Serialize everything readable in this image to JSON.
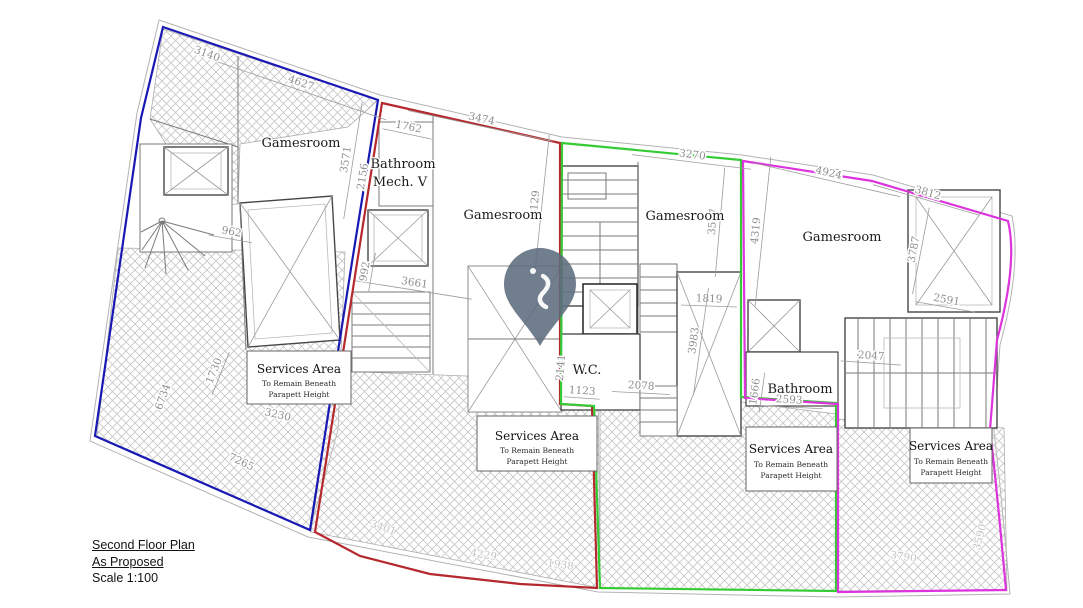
{
  "title_block": {
    "line1": "Second Floor Plan",
    "line2": "As Proposed",
    "line3": "Scale 1:100"
  },
  "colors": {
    "unit1_outline": "#1818b4",
    "unit2_outline": "#b5282d",
    "unit3_outline": "#35cb35",
    "unit4_outline": "#dd33dd",
    "pin_fill": "#5c6b7d",
    "dim_text": "#8e8e8e",
    "wall": "#7a7a7a",
    "hatch_line": "#c6c6c6"
  },
  "icons": {
    "pin": "location-pin-icon"
  },
  "plan": {
    "rooms": [
      {
        "label": "Gamesroom",
        "x": 301,
        "y": 147
      },
      {
        "label": "Bathroom",
        "x": 403,
        "y": 168
      },
      {
        "label": "Mech. V",
        "x": 400,
        "y": 186
      },
      {
        "label": "Gamesroom",
        "x": 503,
        "y": 219
      },
      {
        "label": "Gamesroom",
        "x": 685,
        "y": 220
      },
      {
        "label": "Gamesroom",
        "x": 842,
        "y": 241
      },
      {
        "label": "W.C.",
        "x": 587,
        "y": 374
      },
      {
        "label": "Bathroom",
        "x": 800,
        "y": 393
      }
    ],
    "service_note": {
      "title": "Services Area",
      "line2": "To Remain Beneath",
      "line3": "Parapett Height"
    },
    "dimensions": [
      {
        "v": "4627",
        "x": 300,
        "y": 86,
        "r": 19,
        "len": 185
      },
      {
        "v": "3140",
        "x": 206,
        "y": 57,
        "r": 20,
        "len": 0
      },
      {
        "v": "1762",
        "x": 408,
        "y": 130,
        "r": 12,
        "len": 50
      },
      {
        "v": "3474",
        "x": 481,
        "y": 122,
        "r": 12,
        "len": 148
      },
      {
        "v": "3270",
        "x": 692,
        "y": 158,
        "r": 7,
        "len": 120
      },
      {
        "v": "4924",
        "x": 828,
        "y": 176,
        "r": 13,
        "len": 150
      },
      {
        "v": "3812",
        "x": 927,
        "y": 196,
        "r": 16,
        "len": 110
      },
      {
        "v": "3571",
        "x": 349,
        "y": 160,
        "r": -81,
        "len": 118
      },
      {
        "v": "2156",
        "x": 366,
        "y": 177,
        "r": -81,
        "len": 0
      },
      {
        "v": "4129",
        "x": 538,
        "y": 204,
        "r": -84,
        "len": 140
      },
      {
        "v": "3517",
        "x": 716,
        "y": 222,
        "r": -85,
        "len": 110
      },
      {
        "v": "4319",
        "x": 759,
        "y": 231,
        "r": -84,
        "len": 150
      },
      {
        "v": "3787",
        "x": 917,
        "y": 250,
        "r": -79,
        "len": 88
      },
      {
        "v": "2591",
        "x": 946,
        "y": 303,
        "r": 10,
        "len": 60
      },
      {
        "v": "962",
        "x": 231,
        "y": 235,
        "r": 10,
        "len": 44
      },
      {
        "v": "3661",
        "x": 414,
        "y": 286,
        "r": 9,
        "len": 118
      },
      {
        "v": "992",
        "x": 368,
        "y": 272,
        "r": -80,
        "len": 40
      },
      {
        "v": "1123",
        "x": 582,
        "y": 394,
        "r": 4,
        "len": 36
      },
      {
        "v": "2141",
        "x": 564,
        "y": 368,
        "r": -85,
        "len": 0
      },
      {
        "v": "2078",
        "x": 641,
        "y": 389,
        "r": 3,
        "len": 58
      },
      {
        "v": "1819",
        "x": 709,
        "y": 302,
        "r": 2,
        "len": 56
      },
      {
        "v": "3983",
        "x": 697,
        "y": 341,
        "r": -82,
        "len": 108
      },
      {
        "v": "1666",
        "x": 758,
        "y": 392,
        "r": -82,
        "len": 40
      },
      {
        "v": "2593",
        "x": 789,
        "y": 403,
        "r": 3,
        "len": 68
      },
      {
        "v": "2047",
        "x": 871,
        "y": 359,
        "r": 4,
        "len": 60
      },
      {
        "v": "1730",
        "x": 217,
        "y": 372,
        "r": -68,
        "len": 46
      },
      {
        "v": "6734",
        "x": 166,
        "y": 398,
        "r": -70,
        "len": 0
      },
      {
        "v": "7265",
        "x": 240,
        "y": 465,
        "r": 25,
        "len": 0
      },
      {
        "v": "3230",
        "x": 277,
        "y": 418,
        "r": 13,
        "len": 0
      },
      {
        "v": "3401",
        "x": 382,
        "y": 531,
        "r": 20,
        "len": 0,
        "faint": true
      },
      {
        "v": "4229",
        "x": 483,
        "y": 558,
        "r": 10,
        "len": 0,
        "faint": true
      },
      {
        "v": "1938",
        "x": 560,
        "y": 568,
        "r": 8,
        "len": 0,
        "faint": true
      },
      {
        "v": "3790",
        "x": 903,
        "y": 560,
        "r": 8,
        "len": 0,
        "faint": true
      },
      {
        "v": "3590",
        "x": 983,
        "y": 538,
        "r": -75,
        "len": 0,
        "faint": true
      }
    ]
  }
}
